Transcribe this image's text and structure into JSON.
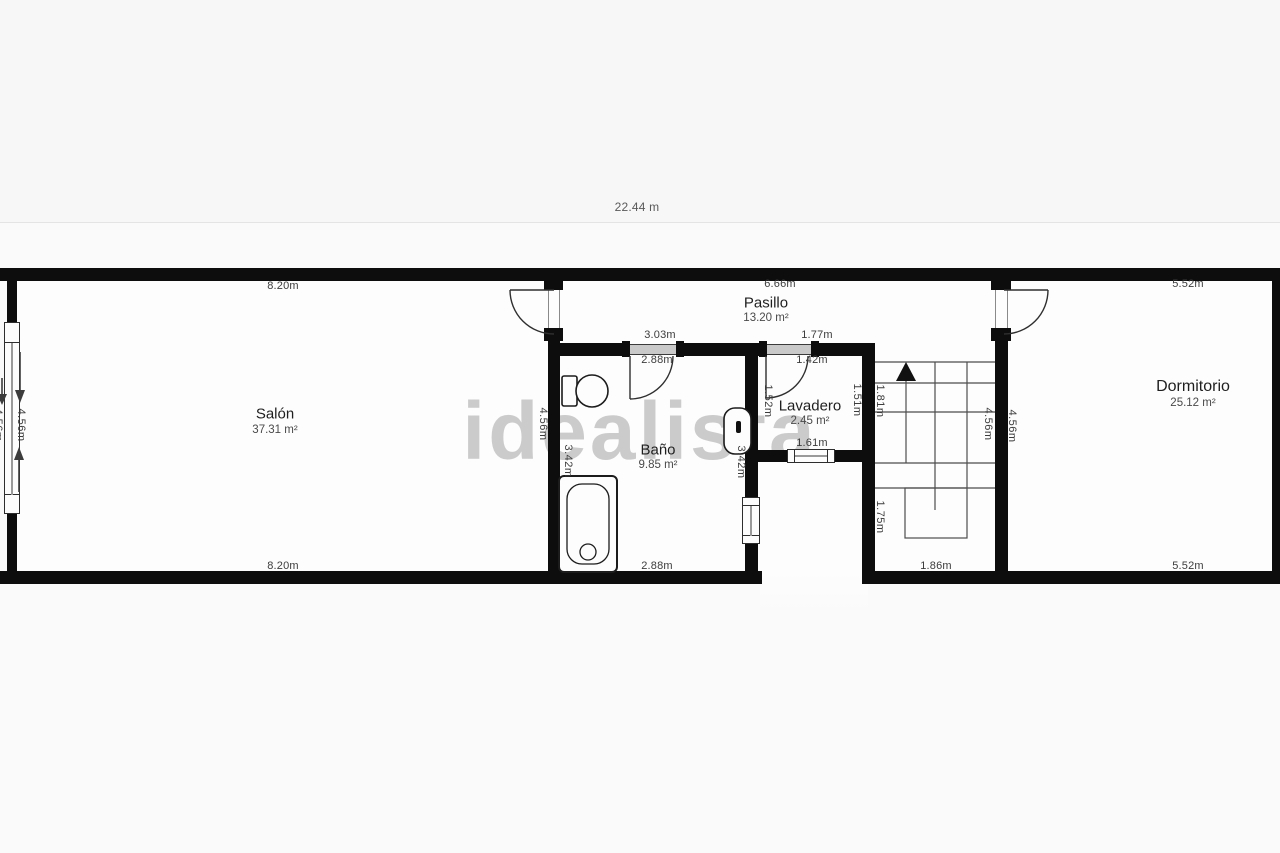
{
  "plan": {
    "total_width_label": "22.44 m",
    "watermark": "idealista",
    "colors": {
      "wall": "#0d0d0d",
      "floor": "#fdfdfd",
      "background": "#f7f7f7",
      "dim_text": "#3c3c3c",
      "watermark": "#9e9e9e"
    },
    "rooms": {
      "salon": {
        "name": "Salón",
        "area": "37.31 m²",
        "dim_top": "8.20m",
        "dim_bottom": "8.20m",
        "dim_left_inner": "4.56m",
        "dim_left_outer": "4.56m"
      },
      "pasillo": {
        "name": "Pasillo",
        "area": "13.20 m²",
        "dim_top": "6.66m"
      },
      "bano": {
        "name": "Baño",
        "area": "9.85 m²",
        "dim_door_top": "3.03m",
        "dim_door_bottom": "2.88m",
        "dim_bottom": "2.88m",
        "dim_wall_left_upper": "4.56m",
        "dim_wall_left_lower": "3.42m",
        "dim_wall_right": "3.42m"
      },
      "lavadero": {
        "name": "Lavadero",
        "area": "2.45 m²",
        "dim_door_top": "1.77m",
        "dim_door_bottom": "1.42m",
        "dim_bottom": "1.61m",
        "dim_left": "1.52m",
        "dim_right": "1.51m"
      },
      "stairs": {
        "dim_upper_left": "1.81m",
        "dim_lower_left": "1.75m",
        "dim_right": "4.56m",
        "dim_bottom": "1.86m"
      },
      "dormitorio": {
        "name": "Dormitorio",
        "area": "25.12 m²",
        "dim_top": "5.52m",
        "dim_bottom": "5.52m",
        "dim_left": "4.56m"
      }
    }
  }
}
